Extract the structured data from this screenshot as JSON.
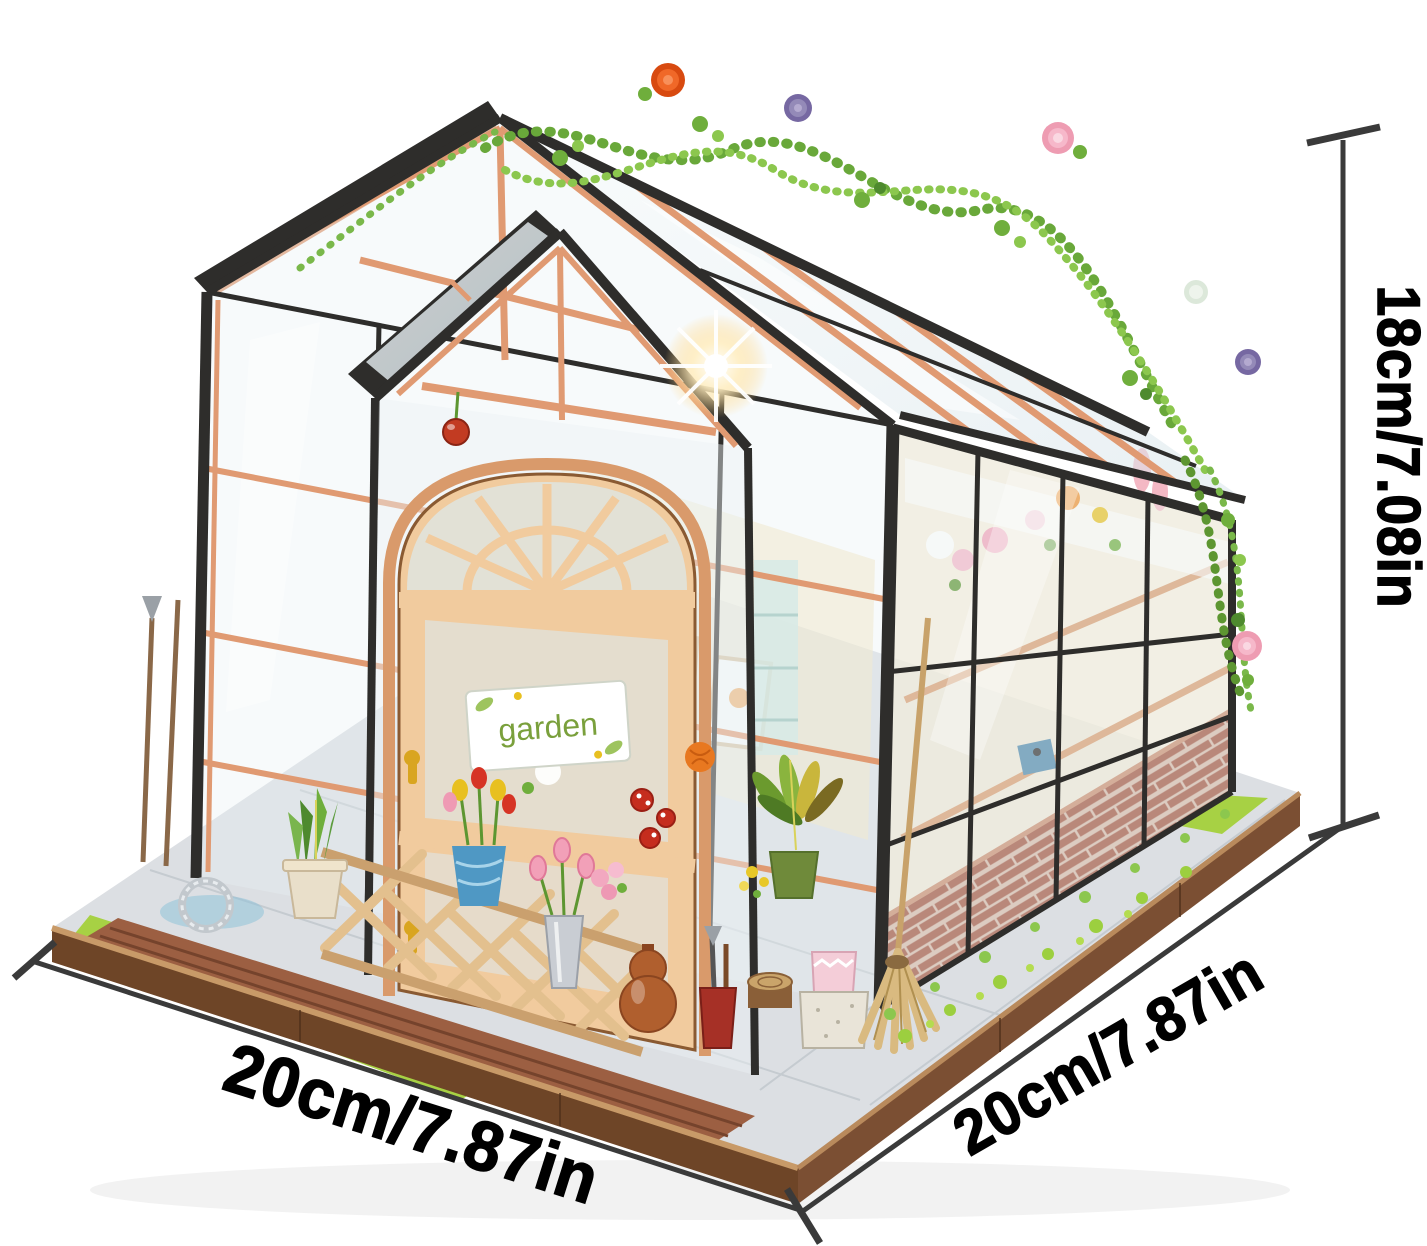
{
  "subject": "DIY miniature greenhouse flower-house kit on wooden display base",
  "background_color": "#ffffff",
  "annotations": {
    "height_label": "18cm/7.08in",
    "width_left_label": "20cm/7.87in",
    "depth_right_label": "20cm/7.87in",
    "line_color": "#3a3a3a",
    "label_color": "#000000"
  },
  "door_sign_text": "garden",
  "palette": {
    "frame_black": "#2e2d2b",
    "wood_trim": "#e09a72",
    "door_wood": "#f1cb9e",
    "glass_tint": "#dce9ee",
    "brick": "#a0503a",
    "brick_mortar": "#d6b8a6",
    "grass": "#a7d144",
    "moss": "#8cc74e",
    "vine_green": "#69a83a",
    "base_wood_side": "#6e4527",
    "base_wood_rim": "#c89a68",
    "walkway_plank": "#9c5f42",
    "pavement": "#dcdfe3",
    "rose_orange": "#e85420",
    "rose_purple": "#8878b0",
    "rose_pink": "#ee9cb2",
    "tulip_red": "#d63425",
    "tulip_yellow": "#e8c020",
    "broom_straw": "#d9ba80",
    "sign_text_green": "#7aa03c"
  }
}
